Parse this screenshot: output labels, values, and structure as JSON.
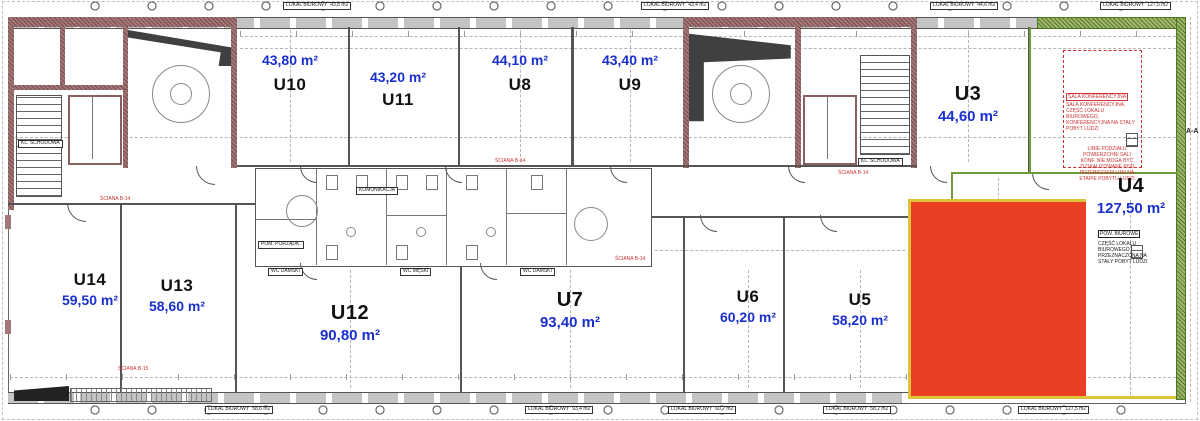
{
  "colors": {
    "highlight_red": "#ea3f23",
    "highlight_yellow": "#ddc33c",
    "boundary_green": "#6f9c39",
    "wall_maroon": "#a17878",
    "area_text_blue": "#1a30cc",
    "annotation_red": "#cc3333"
  },
  "units": {
    "u3": {
      "id": "U3",
      "area": "44,60 m²"
    },
    "u4": {
      "id": "U4",
      "area": "127,50 m²"
    },
    "u5": {
      "id": "U5",
      "area": "58,20 m²"
    },
    "u6": {
      "id": "U6",
      "area": "60,20 m²"
    },
    "u7": {
      "id": "U7",
      "area": "93,40 m²"
    },
    "u8": {
      "id": "U8",
      "area": "44,10 m²"
    },
    "u9": {
      "id": "U9",
      "area": "43,40 m²"
    },
    "u10": {
      "id": "U10",
      "area": "43,80 m²"
    },
    "u11": {
      "id": "U11",
      "area": "43,20 m²"
    },
    "u12": {
      "id": "U12",
      "area": "90,80 m²"
    },
    "u13": {
      "id": "U13",
      "area": "58,60 m²"
    },
    "u14": {
      "id": "U14",
      "area": "59,50 m²"
    }
  },
  "edge_labels": {
    "lokal_label": "LOKAL BIUROWY",
    "top_areas": [
      "43,8 m2",
      "43,4 m2",
      "44,6 m2",
      "127,5 m2"
    ],
    "bottom_areas": [
      "58,6 m2",
      "93,4 m2",
      "60,2 m2",
      "58,2 m2",
      "127,5 m2"
    ]
  },
  "core_labels": {
    "stair_left": "KL. SCHODOWA",
    "stair_right": "KL. SCHODOWA"
  },
  "room_labels": {
    "komunikacja": "KOMUNIKACJA",
    "wc_damski": "WC DAMSKI",
    "wc_meski": "WC MĘSKI",
    "pom": "POM. PORZĄDK."
  },
  "annotations": {
    "conference_title": "SALA KONFERENCYJNA",
    "conference_lines": "SALA KONFERENCYJNA, CZĘŚĆ LOKALU BIUROWEGO, KONFERENCYJNA NA STAŁY POBYT LUDZI",
    "conference_note": "LINIE PODZIAŁU POWIERZCHNI SALI KONF. NIE MOGĄ BYĆ ZLOKALIZOWANE POD PRZEBIEGIEM LINII NA ETAPIE POBYTU LUDZI",
    "pow_title": "POW. BIUROWE",
    "pow_lines": "CZĘŚĆ LOKALU BIUROWEGO PRZEZNACZONA NA STAŁY POBYT LUDZI",
    "sciana_1": "ŚCIANA B-14",
    "sciana_2": "ŚCIANA B-14",
    "sciana_3": "ŚCIANA B-15",
    "section": "A-A"
  }
}
